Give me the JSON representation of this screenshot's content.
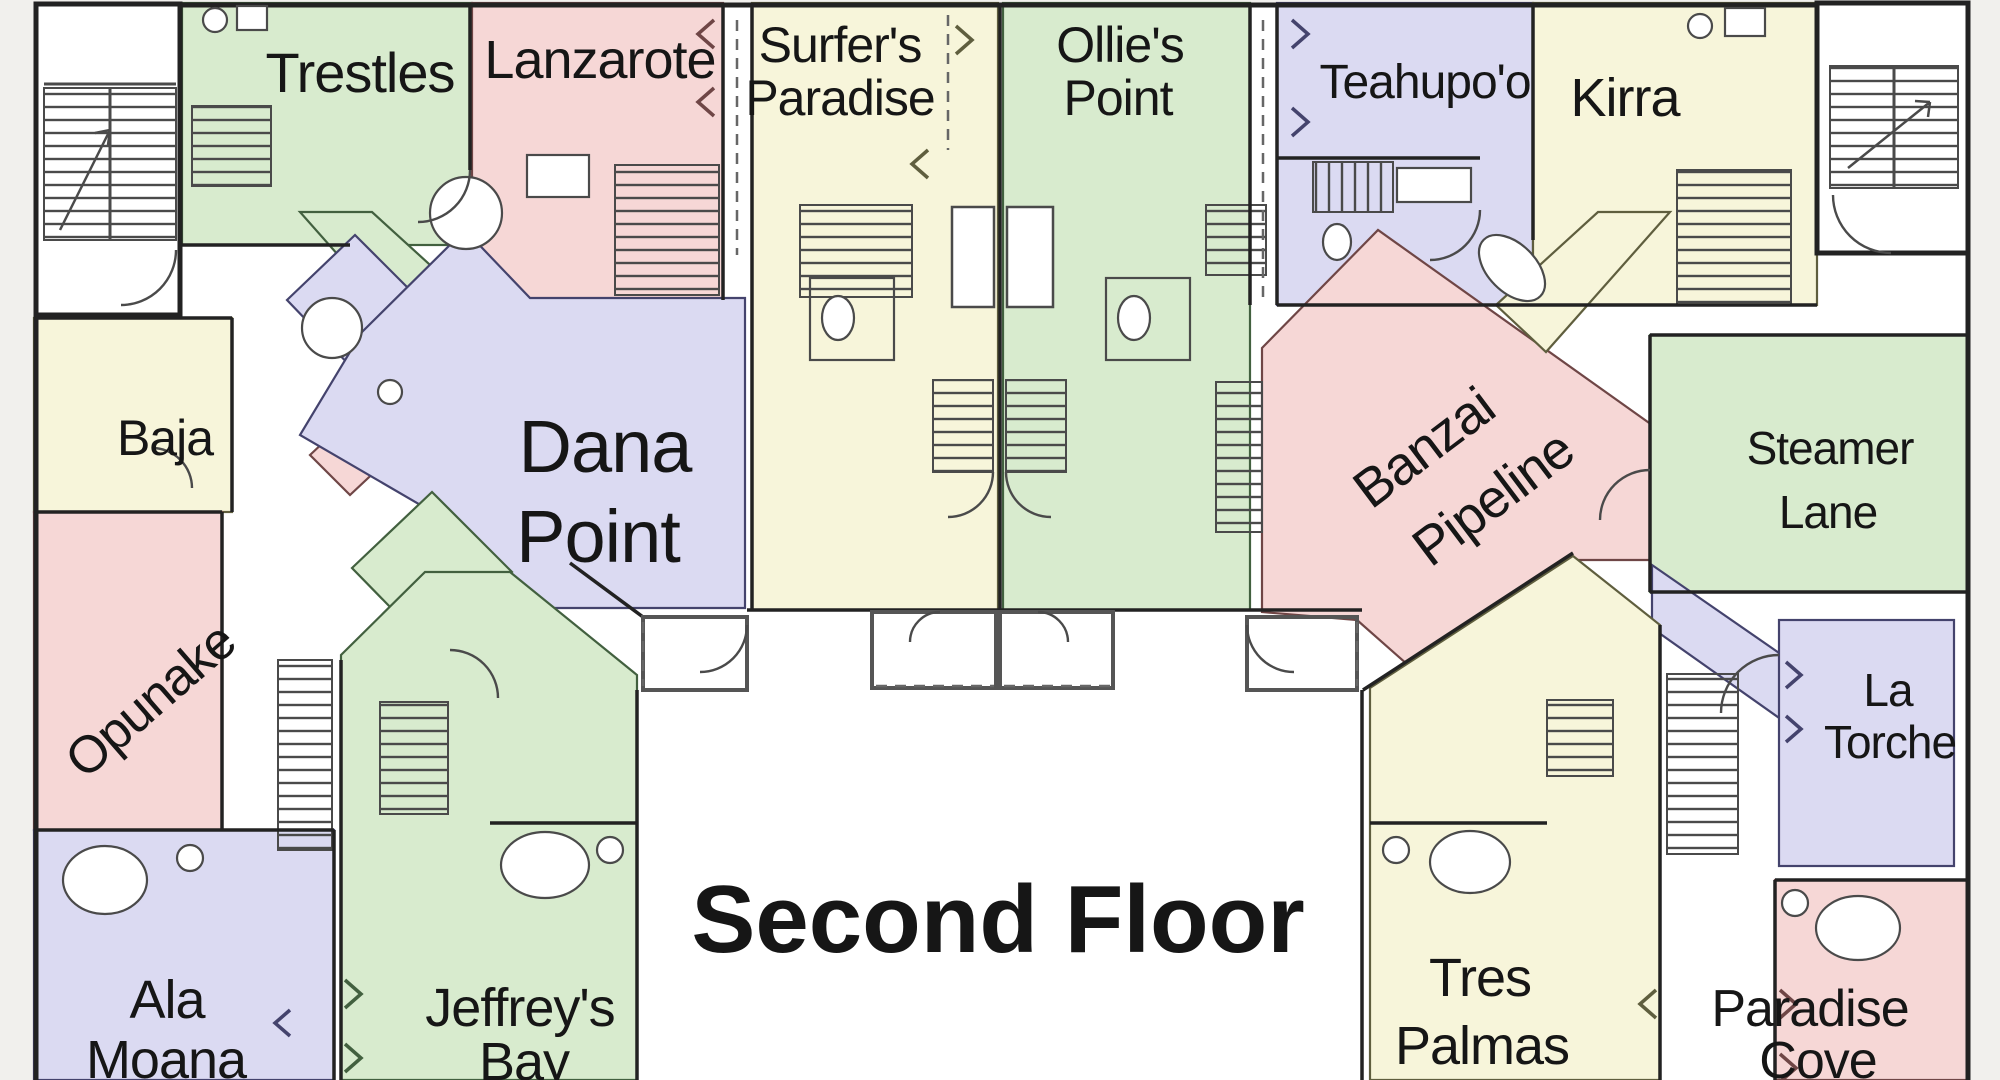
{
  "title": "Second Floor",
  "palette": {
    "green": "#d8ebce",
    "pink": "#f6d7d6",
    "cream": "#f7f5da",
    "lavender": "#dbdaf2",
    "floor": "#ffffff",
    "outside": "#f1f0ed",
    "wall": "#222222",
    "porch_wall": "#555555",
    "detail": "#4a4a4a",
    "dash": "#666666",
    "green_line": "#42603f",
    "pink_line": "#6f4646",
    "cream_line": "#5f5e3e",
    "lavender_line": "#44436d",
    "text": "#161616"
  },
  "units": {
    "trestles": {
      "line1": "Trestles",
      "color": "green"
    },
    "lanzarote": {
      "line1": "Lanzarote",
      "color": "pink"
    },
    "surfers_paradise": {
      "line1": "Surfer's",
      "line2": "Paradise",
      "color": "cream"
    },
    "ollies_point": {
      "line1": "Ollie's",
      "line2": "Point",
      "color": "green"
    },
    "teahupoo": {
      "line1": "Teahupo'o",
      "color": "lavender"
    },
    "kirra": {
      "line1": "Kirra",
      "color": "cream"
    },
    "baja": {
      "line1": "Baja",
      "color": "cream"
    },
    "dana_point": {
      "line1": "Dana",
      "line2": "Point",
      "color": "lavender"
    },
    "opunake": {
      "line1": "Opunake",
      "color": "pink"
    },
    "banzai_pipeline": {
      "line1": "Banzai",
      "line2": "Pipeline",
      "color": "pink"
    },
    "steamer_lane": {
      "line1": "Steamer",
      "line2": "Lane",
      "color": "green"
    },
    "la_torche": {
      "line1": "La",
      "line2": "Torche",
      "color": "lavender"
    },
    "ala_moana": {
      "line1": "Ala",
      "line2": "Moana",
      "color": "lavender"
    },
    "jeffreys_bay": {
      "line1": "Jeffrey's",
      "line2": "Bay",
      "color": "green"
    },
    "tres_palmas": {
      "line1": "Tres",
      "line2": "Palmas",
      "color": "cream"
    },
    "paradise_cove": {
      "line1": "Paradise",
      "line2": "Cove",
      "color": "pink"
    }
  }
}
